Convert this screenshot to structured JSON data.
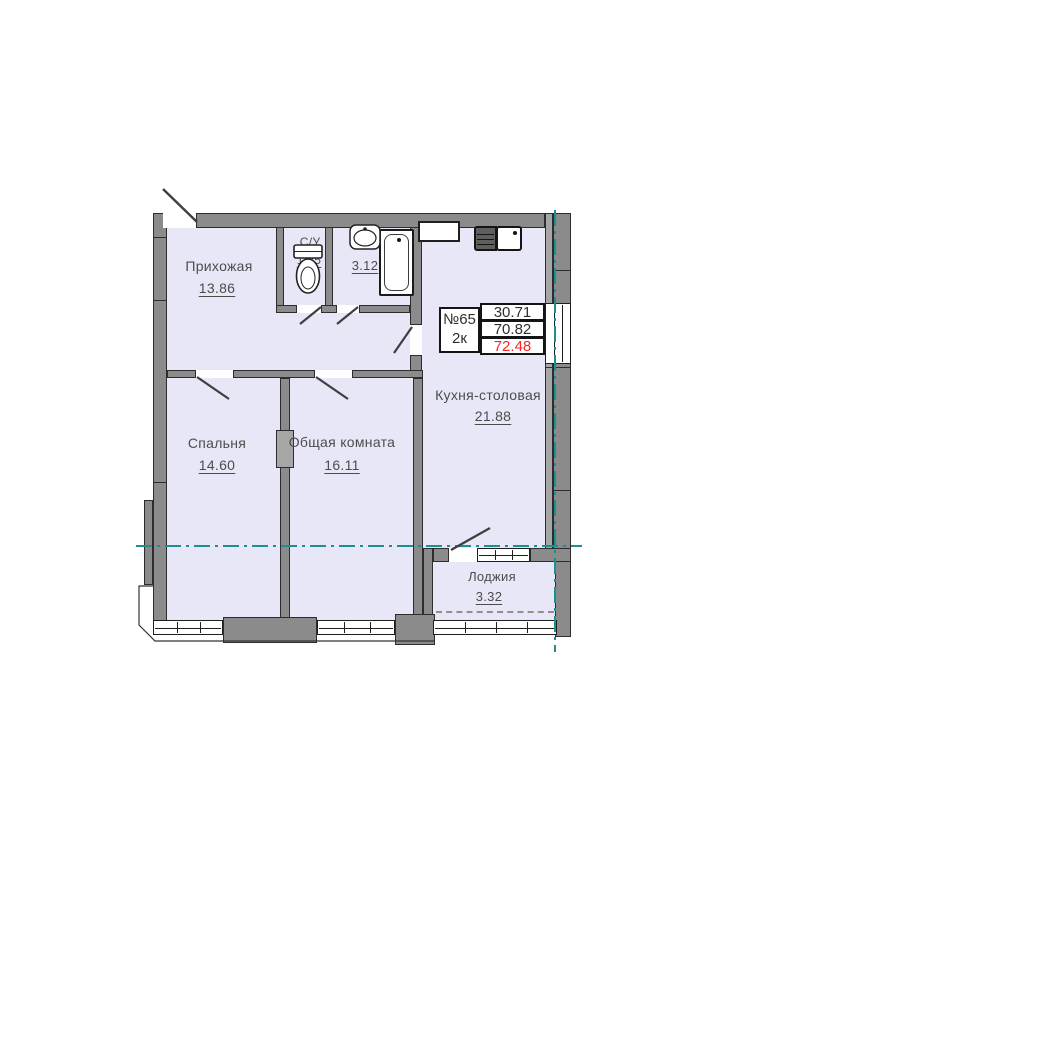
{
  "unit": {
    "number": "№65",
    "type": "2к",
    "area_living": "30.71",
    "area_main": "70.82",
    "area_total": "72.48"
  },
  "rooms": {
    "hallway": {
      "name": "Прихожая",
      "area": "13.86"
    },
    "wc1": {
      "name": "С/У",
      "area": "1.25"
    },
    "wc2": {
      "name": "С/У",
      "area": "3.12"
    },
    "kitchen": {
      "name": "Кухня-столовая",
      "area": "21.88"
    },
    "bedroom": {
      "name": "Спальня",
      "area": "14.60"
    },
    "living": {
      "name": "Общая комната",
      "area": "16.11"
    },
    "loggia": {
      "name": "Лоджия",
      "area": "3.32"
    }
  },
  "colors": {
    "room_fill": "#e8e7f8",
    "wall_gray": "#8b8b8b",
    "outline_dark": "#2d2d2d",
    "axis_teal": "#1e8f8f",
    "total_area_red": "#ee2b2b",
    "label_text": "#4c4c4c"
  }
}
